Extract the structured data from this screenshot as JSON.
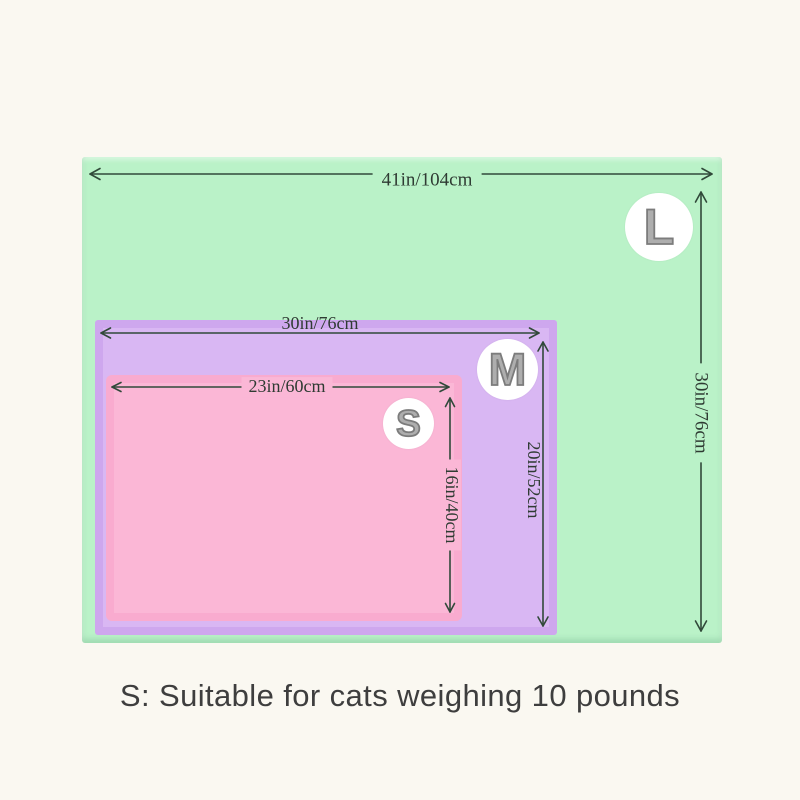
{
  "page": {
    "caption": "S: Suitable for cats weighing 10 pounds"
  },
  "sizes": {
    "large": {
      "letter": "L",
      "width": "41in/104cm",
      "height": "30in/76cm"
    },
    "medium": {
      "letter": "M",
      "width": "30in/76cm",
      "height": "20in/52cm"
    },
    "small": {
      "letter": "S",
      "width": "23in/60cm",
      "height": "16in/40cm"
    }
  },
  "colors": {
    "large-mat": "#baf2c8",
    "medium-mat": "#d9b7f3",
    "small-mat": "#fbb7d6",
    "background": "#faf8f1",
    "arrow": "#31493a",
    "badge-bg": "#ffffff",
    "badge-letter": "#aeaeae",
    "badge-outline": "#7c7c7c",
    "caption-text": "#3e3e3e"
  }
}
